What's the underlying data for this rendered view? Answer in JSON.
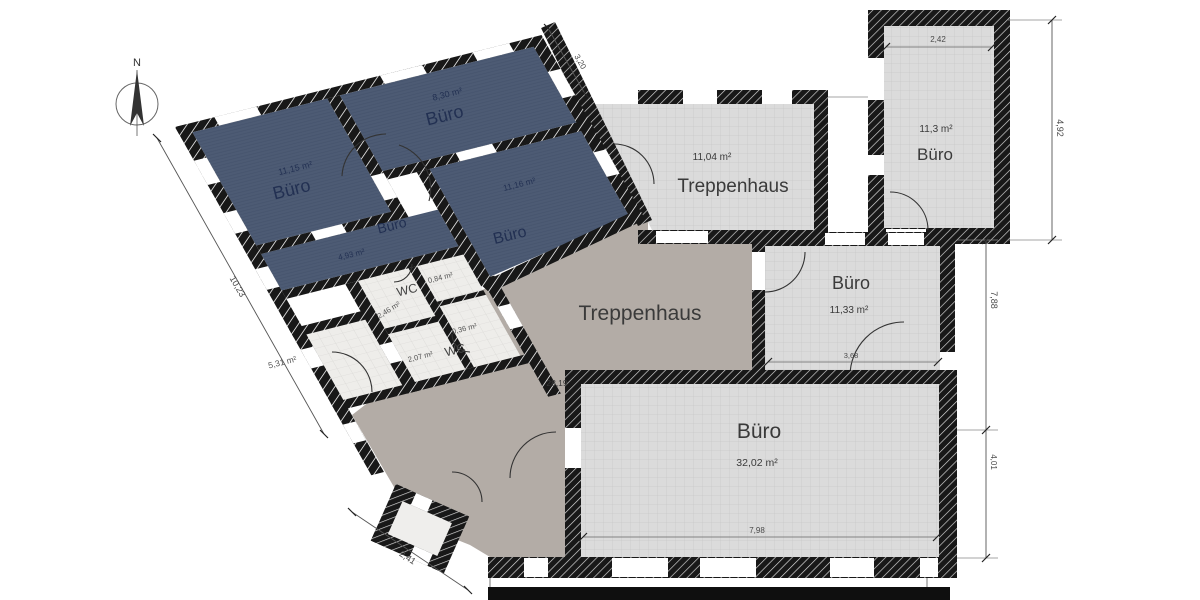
{
  "compass": {
    "north_label": "N"
  },
  "rooms": {
    "buero_11_15": {
      "label": "Büro",
      "area": "11,15 m²"
    },
    "buero_8_30": {
      "label": "Büro",
      "area": "8,30 m²"
    },
    "buero_4_93": {
      "label": "Büro",
      "area": "4,93 m²"
    },
    "buero_11_16": {
      "label": "Büro",
      "area": "11,16 m²"
    },
    "wc_upper": {
      "label": "WC",
      "area": "2,46 m²"
    },
    "cell_0_84": {
      "area": "0,84 m²"
    },
    "cell_0_36": {
      "area": "0,36 m²"
    },
    "wc_lower": {
      "label": "WC",
      "area": "2,07 m²"
    },
    "room_5_31": {
      "area": "5,31 m²"
    },
    "treppenhaus_upper": {
      "label": "Treppenhaus",
      "area": "11,04 m²"
    },
    "treppenhaus_main": {
      "label": "Treppenhaus",
      "area": "28,19"
    },
    "buero_11_3": {
      "label": "Büro",
      "area": "11,3 m²"
    },
    "buero_11_33": {
      "label": "Büro",
      "area": "11,33 m²"
    },
    "buero_32_02": {
      "label": "Büro",
      "area": "32,02 m²"
    }
  },
  "dimensions": {
    "buero_11_3_width": "2,42",
    "buero_11_3_height": "4,92",
    "right_upper_height": "7,88",
    "right_lower_height": "4,01",
    "buero_11_33_width": "3,68",
    "buero_32_02_width": "7,98",
    "left_facade_length": "10,23",
    "bay_width": "2,41",
    "wing_edge_length": "3,20"
  },
  "colors": {
    "wall": "#181818",
    "dark_room": "#4d5b74",
    "light_room": "#dbdbdb",
    "hall_floor": "#b3aca6",
    "dark_room_text": "#223052"
  }
}
